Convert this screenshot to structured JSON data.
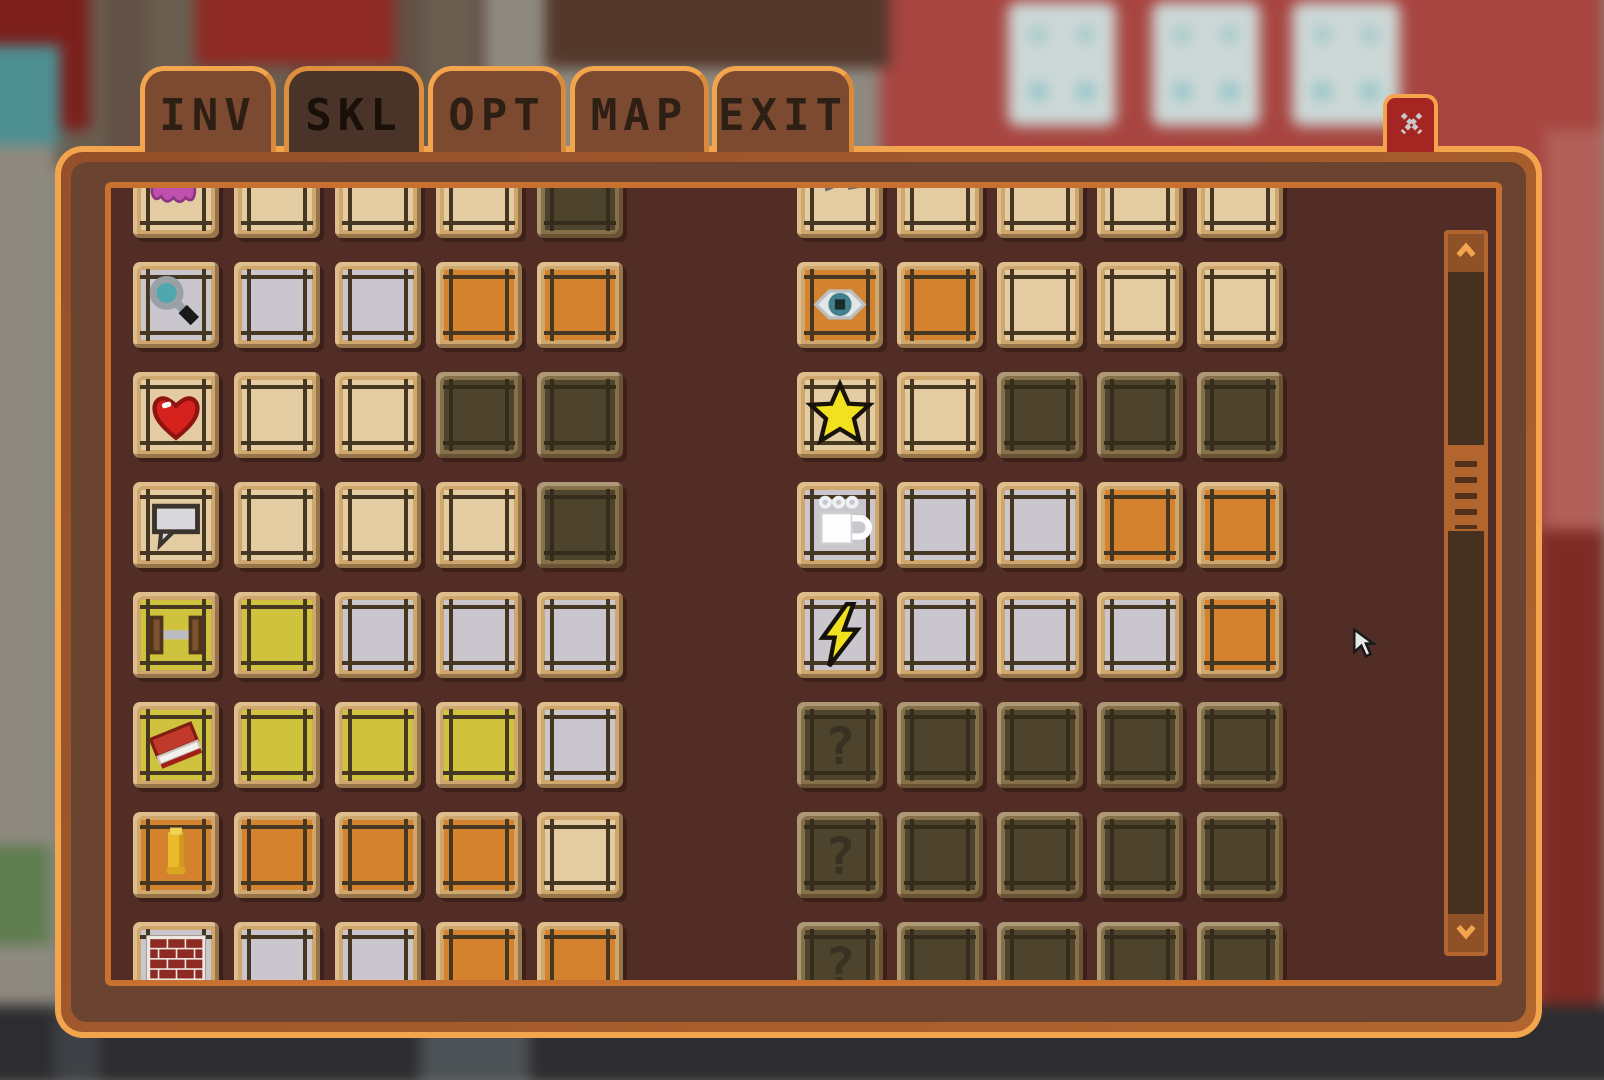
{
  "tabs": {
    "items": [
      {
        "label": "INV",
        "selected": false
      },
      {
        "label": "SKL",
        "selected": true
      },
      {
        "label": "OPT",
        "selected": false
      },
      {
        "label": "MAP",
        "selected": false
      },
      {
        "label": "EXIT",
        "selected": false
      }
    ]
  },
  "close_button": {
    "icon": "close-x-icon"
  },
  "glyphs": {
    "question_mark": "?"
  },
  "skills_panel": {
    "left_grid": {
      "rows": [
        {
          "icon": "brain-icon",
          "icon_slot": "tan",
          "slots": [
            "tan",
            "tan",
            "tan",
            "dark"
          ]
        },
        {
          "icon": "magnifier-icon",
          "icon_slot": "silver",
          "slots": [
            "silver",
            "silver",
            "orange",
            "orange"
          ]
        },
        {
          "icon": "heart-icon",
          "icon_slot": "tan",
          "slots": [
            "tan",
            "tan",
            "dark",
            "dark"
          ]
        },
        {
          "icon": "speech-bubble-icon",
          "icon_slot": "tan",
          "slots": [
            "tan",
            "tan",
            "tan",
            "dark"
          ]
        },
        {
          "icon": "dumbbell-icon",
          "icon_slot": "yellow",
          "slots": [
            "yellow",
            "silver",
            "silver",
            "silver"
          ]
        },
        {
          "icon": "book-icon",
          "icon_slot": "yellow",
          "slots": [
            "yellow",
            "yellow",
            "yellow",
            "silver"
          ]
        },
        {
          "icon": "bullet-icon",
          "icon_slot": "orange",
          "slots": [
            "orange",
            "orange",
            "orange",
            "tan"
          ]
        },
        {
          "icon": "brick-wall-icon",
          "icon_slot": "silver",
          "slots": [
            "silver",
            "silver",
            "orange",
            "orange"
          ]
        }
      ]
    },
    "right_grid": {
      "rows": [
        {
          "icon": "tools-icon",
          "icon_slot": "tan",
          "slots": [
            "tan",
            "tan",
            "tan",
            "tan"
          ]
        },
        {
          "icon": "eye-icon",
          "icon_slot": "orange",
          "slots": [
            "orange",
            "tan",
            "tan",
            "tan"
          ]
        },
        {
          "icon": "star-icon",
          "icon_slot": "tan",
          "slots": [
            "tan",
            "dark",
            "dark",
            "dark"
          ]
        },
        {
          "icon": "coffee-mug-icon",
          "icon_slot": "silver",
          "slots": [
            "silver",
            "silver",
            "orange",
            "orange"
          ]
        },
        {
          "icon": "lightning-icon",
          "icon_slot": "silver",
          "slots": [
            "silver",
            "silver",
            "silver",
            "orange"
          ]
        },
        {
          "icon": "question-mark-icon",
          "icon_slot": "dark",
          "slots": [
            "dark",
            "dark",
            "dark",
            "dark"
          ]
        },
        {
          "icon": "question-mark-icon",
          "icon_slot": "dark",
          "slots": [
            "dark",
            "dark",
            "dark",
            "dark"
          ]
        },
        {
          "icon": "question-mark-icon",
          "icon_slot": "dark",
          "slots": [
            "dark",
            "dark",
            "dark",
            "dark"
          ]
        }
      ]
    },
    "scrollbar": {
      "up_icon": "scroll-up-icon",
      "down_icon": "scroll-down-icon",
      "thumb_position": "upper-third"
    }
  },
  "colors": {
    "panel_border_light": "#f2a54d",
    "panel_border": "#a85d2b",
    "panel_band": "#6a4331",
    "panel_accent": "#c8702f",
    "panel_interior": "#512d25",
    "tab_bg": "#7b4a31",
    "tab_selected_bg": "#4a342a",
    "close_bg": "#a52523",
    "slot_frame": "#cfa76c",
    "slot_frame_locked": "#86704a",
    "fill_tan": "#e3cba2",
    "fill_silver": "#c9c7cd",
    "fill_orange": "#d4822e",
    "fill_yellow": "#cfc23c",
    "fill_dark": "#4e432d",
    "scrollbar_thumb": "#b2652e"
  }
}
